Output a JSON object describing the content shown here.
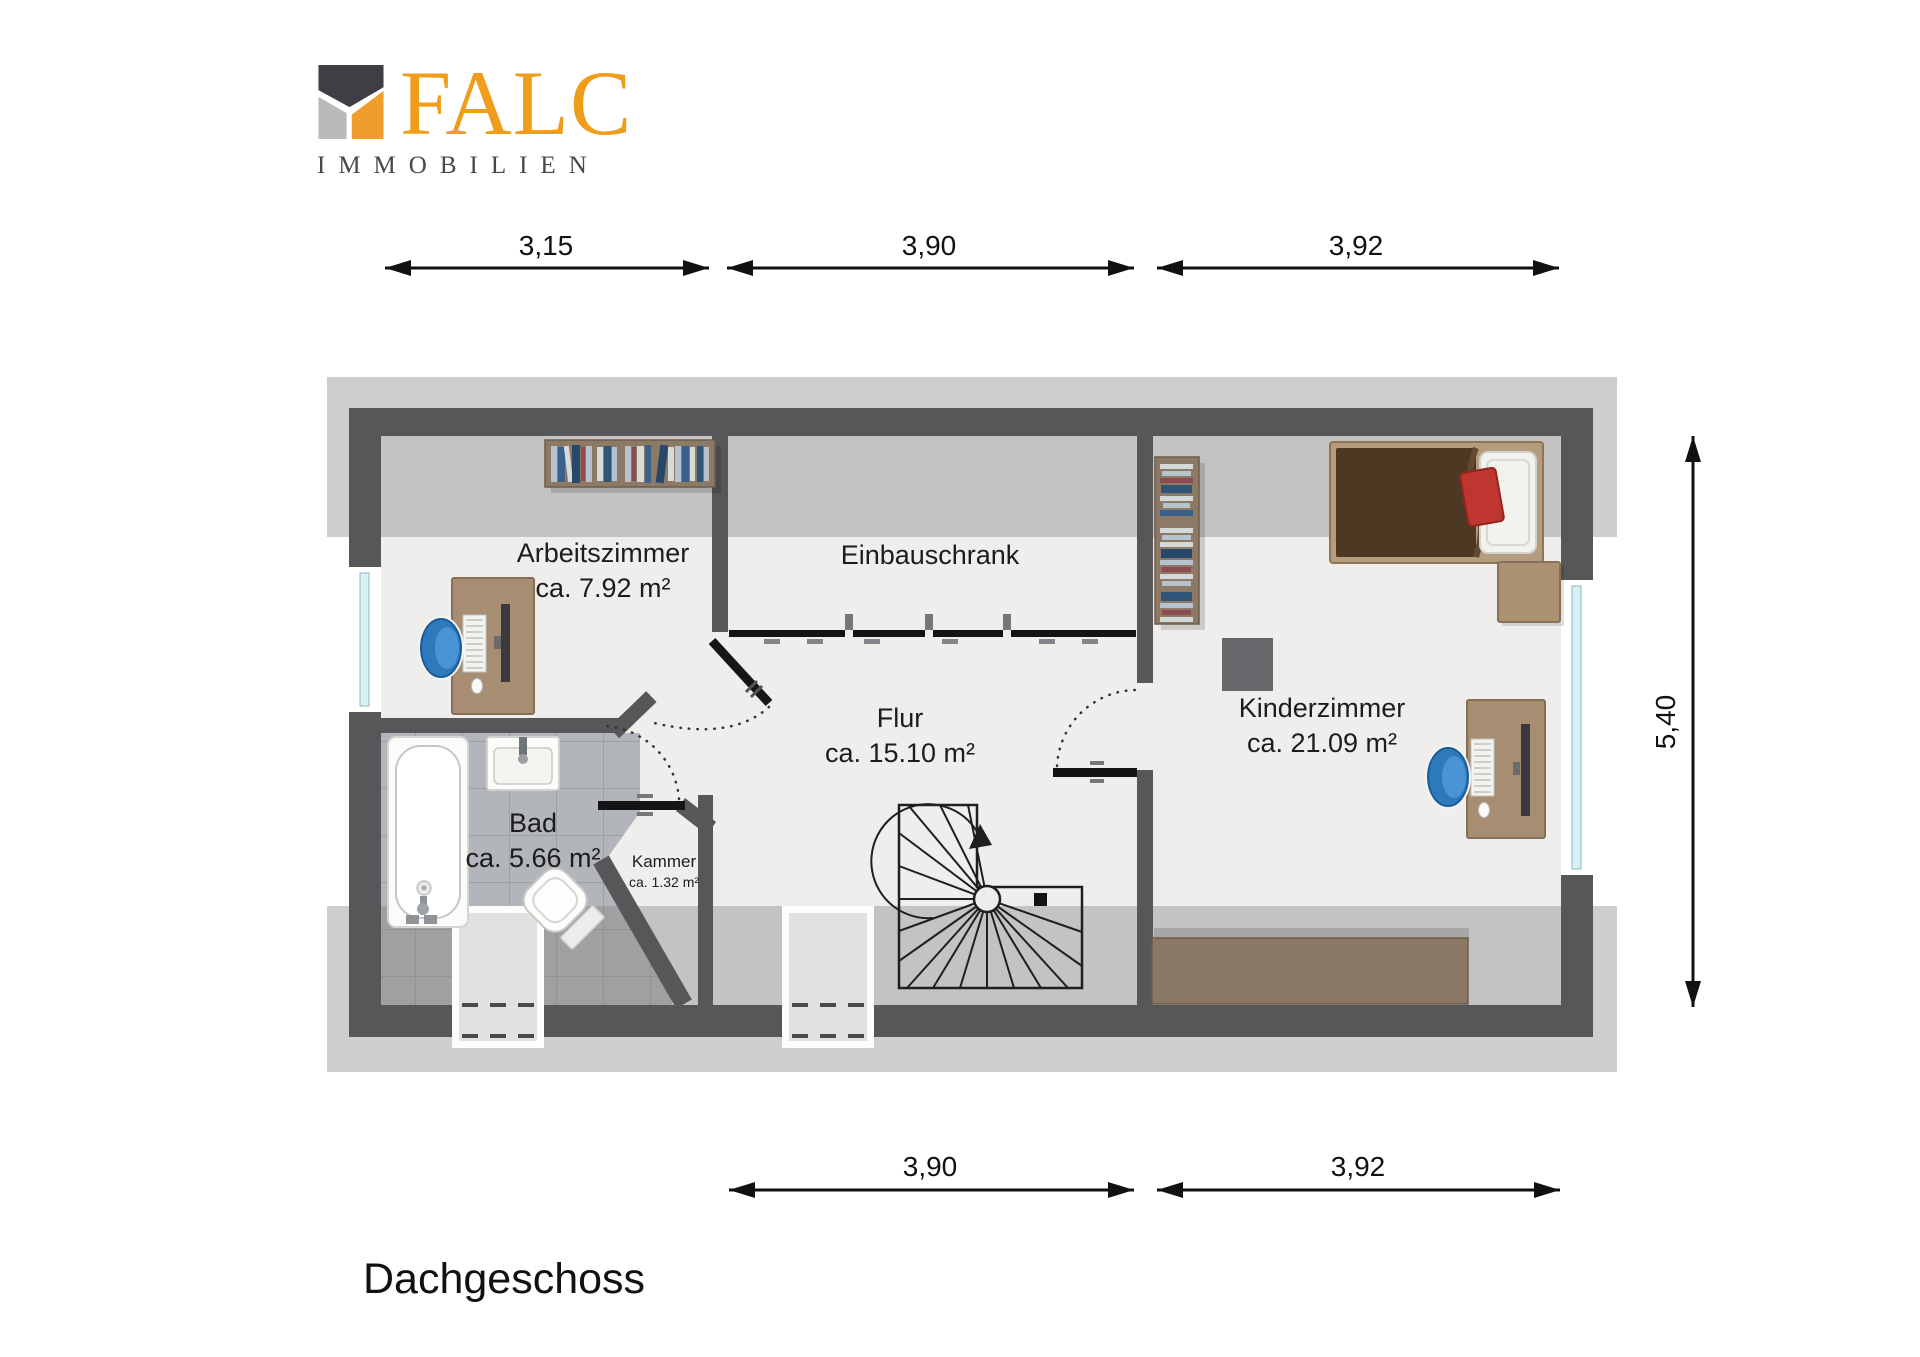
{
  "logo": {
    "brand": "FALC",
    "subtitle": "IMMOBILIEN",
    "accent_color": "#F09D1C"
  },
  "floor_title": "Dachgeschoss",
  "rooms": [
    {
      "name": "Arbeitszimmer",
      "area": "ca. 7.92 m²"
    },
    {
      "name": "Einbauschrank",
      "area": ""
    },
    {
      "name": "Flur",
      "area": "ca. 15.10 m²"
    },
    {
      "name": "Kinderzimmer",
      "area": "ca. 21.09 m²"
    },
    {
      "name": "Bad",
      "area": "ca. 5.66 m²"
    },
    {
      "name": "Kammer",
      "area": "ca. 1.32 m²"
    }
  ],
  "dimensions": {
    "top": [
      "3,15",
      "3,90",
      "3,92"
    ],
    "bottom": [
      "3,90",
      "3,92"
    ],
    "right": [
      "5,40"
    ]
  },
  "colors": {
    "wall": "#57575A",
    "floor": "#EFEEEC",
    "tile": "#B2B5B9",
    "roof_band": "rgba(125,125,125,0.38)",
    "accent": "#F09D1C"
  }
}
